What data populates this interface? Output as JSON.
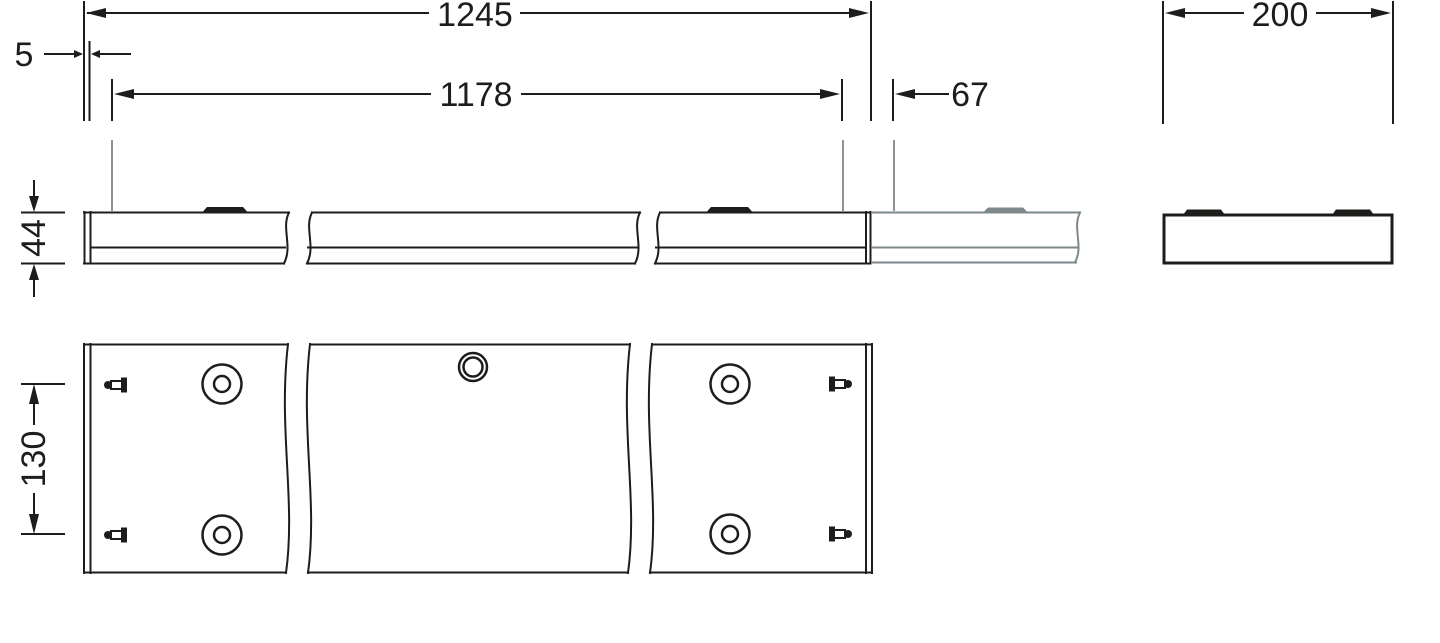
{
  "drawing": {
    "dimensions": {
      "overall_length": "1245",
      "left_end_offset": "5",
      "suspension_distance": "1178",
      "right_end_offset": "67",
      "width": "200",
      "height": "44",
      "hole_row_spacing": "130"
    },
    "colors": {
      "line": "#1d1d1b",
      "continuation_gray": "#7e898c",
      "wire_gray": "#8a9396",
      "background": "#ffffff"
    }
  }
}
